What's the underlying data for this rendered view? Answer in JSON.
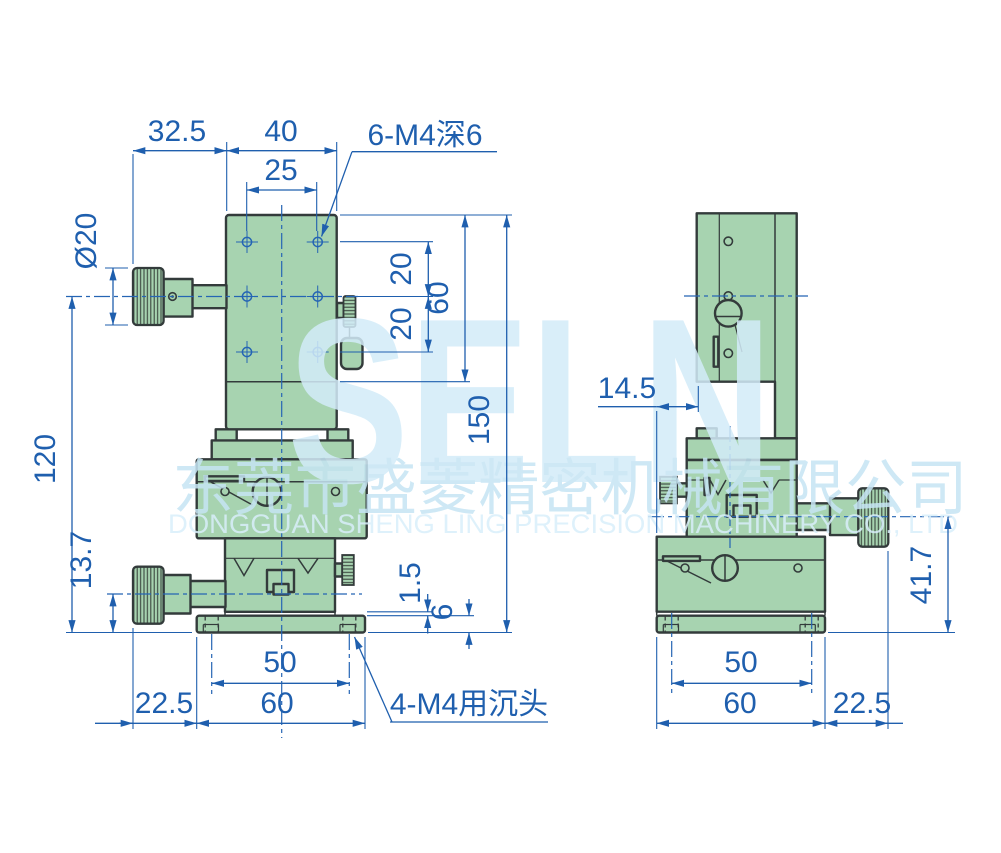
{
  "dims": {
    "front": {
      "knob_offset": "32.5",
      "plate_w": "40",
      "hole_dx": "25",
      "thread_note": "6-M4深6",
      "knob_dia": "Ø20",
      "pitch_a": "20",
      "pitch_b": "20",
      "plate_h": "60",
      "total_h": "150",
      "axis_h": "120",
      "lower_axis_h": "13.7",
      "lip": "1.5",
      "flange_t": "6",
      "hole_span": "50",
      "base_w": "60",
      "overhang": "22.5",
      "csk_note": "4-M4用沉头"
    },
    "side": {
      "offset": "14.5",
      "axis_h": "41.7",
      "hole_span": "50",
      "base_w": "60",
      "overhang": "22.5"
    }
  },
  "watermark": {
    "logo": "SELN",
    "company_cn": "东莞市盛菱精密机械有限公司",
    "company_en": "DONGGUAN SHENG LING PRECISION MACHINERY CO., LTD"
  },
  "colors": {
    "body_fill": "#a7d3b0",
    "outline": "#333b3b",
    "dimension_blue": "#1f5fae",
    "watermark_blue": "#d3ecf9"
  }
}
